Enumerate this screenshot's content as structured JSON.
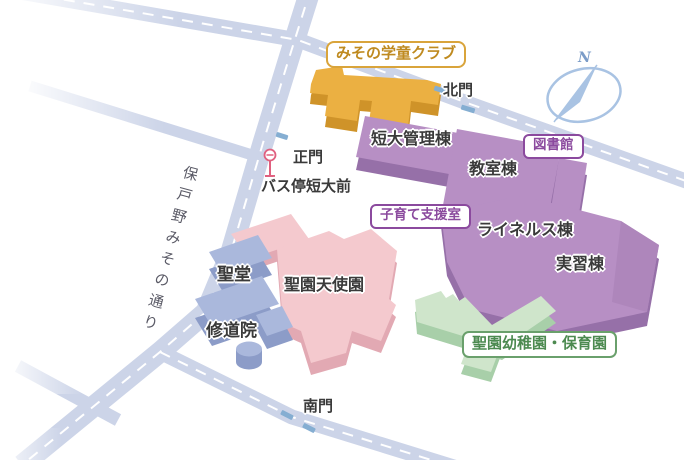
{
  "map": {
    "street": {
      "label": "保戸野みその通り"
    },
    "gates": {
      "north": "北門",
      "main": "正門",
      "south": "南門"
    },
    "bus_stop_label": "バス停短大前",
    "compass": {
      "label": "N"
    },
    "buildings": {
      "gakudo_club": "みその学童クラブ",
      "tandai_admin": "短大管理棟",
      "classroom": "教室棟",
      "library": "図書館",
      "childcare_support": "子育て支援室",
      "reiners": "ライネルス棟",
      "training": "実習棟",
      "chapel": "聖堂",
      "tenshien": "聖園天使園",
      "monastery": "修道院",
      "kindergarten": "聖園幼稚園・保育園"
    },
    "icons": {
      "compass": "compass-icon",
      "bus_stop": "bus-stop-icon",
      "gate_marker": "gate-marker"
    },
    "colors": {
      "road": "#ccd4e8",
      "roadDash": "#ffffff",
      "orangeTop": "#ebb042",
      "orangeSide": "#cf9329",
      "purpleTop": "#b78fc4",
      "purpleSide": "#9670a8",
      "purpleDark": "#ae86bb",
      "pinkTop": "#f4c9ce",
      "pinkSide": "#e2a9b3",
      "blueTop": "#aab8dc",
      "blueSide": "#8c9cc8",
      "greenTop": "#cfe5cb",
      "greenSide": "#a8cfa9",
      "gate": "#85aed2",
      "bus": "#e0607f",
      "compass": "#a9c3e3",
      "compassText": "#7b9cc8",
      "labelOrange": "#bf8a1f",
      "labelOrangeBorder": "#d9a43b",
      "labelPurple": "#8b4a9e",
      "labelGreen": "#4c8a50",
      "labelGreenBorder": "#6aa06c",
      "text": "#3a3a3a",
      "street": "#5a5a66"
    }
  }
}
